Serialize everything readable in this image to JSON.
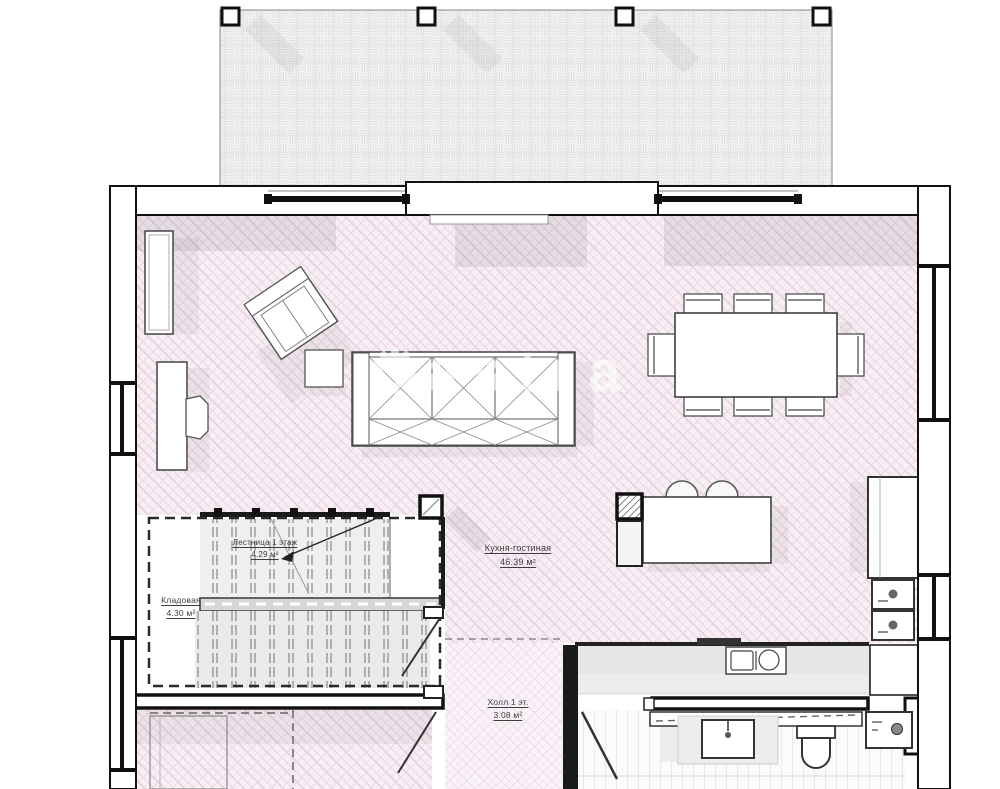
{
  "plan": {
    "rooms": [
      {
        "id": "kitchen-living",
        "name": "Кухня-гостиная",
        "area": "46.39 м²"
      },
      {
        "id": "stairs",
        "name": "Лестница 1 этаж",
        "area": "4.29 м²"
      },
      {
        "id": "storage",
        "name": "Кладовая",
        "area": "4.30 м²"
      },
      {
        "id": "hall",
        "name": "Холл 1 эт.",
        "area": "3.08 м²"
      }
    ],
    "watermark": {
      "gear_icon": "⚙",
      "text": "astra"
    },
    "colors": {
      "floor_pink": "#f7eff4",
      "hatch_pink": "#e3cddc",
      "wall_line": "#1a1a1a",
      "terrace_grey": "#f3f3f3",
      "shadow": "rgba(30,30,30,0.09)"
    }
  }
}
